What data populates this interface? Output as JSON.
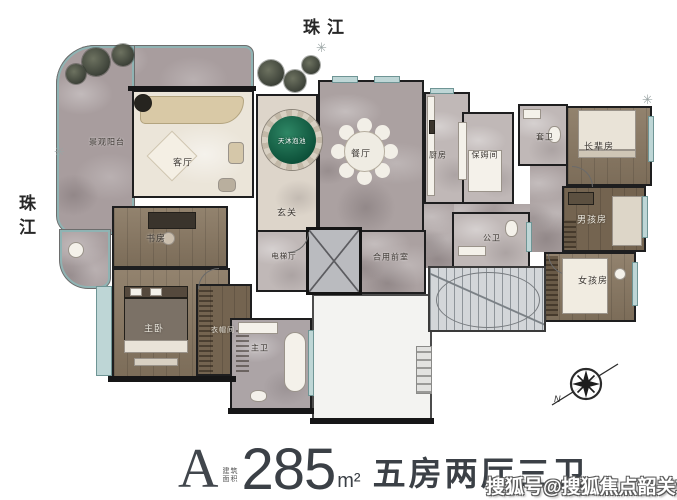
{
  "river_labels": {
    "top": "珠江",
    "left": "珠江"
  },
  "plan": {
    "rooms": {
      "balcony": "景观阳台",
      "living": "客厅",
      "pool": "天沐泡池",
      "foyer": "玄关",
      "dining": "餐厅",
      "kitchen": "厨房",
      "nanny": "保姆间",
      "suite_bath": "套卫",
      "elder": "长辈房",
      "boy": "男孩房",
      "girl": "女孩房",
      "public_bath": "公卫",
      "shared_front": "合用前室",
      "elevator_hall": "电梯厅",
      "study": "书房",
      "master": "主卧",
      "closet": "衣帽间",
      "master_bath": "主卫"
    },
    "compass_north": "N"
  },
  "title": {
    "unit": "A",
    "area_note_line1": "建筑",
    "area_note_line2": "面积",
    "area_value": "285",
    "area_unit": "m²",
    "layout": "五房两厅三卫"
  },
  "watermark": "搜狐号@搜狐焦点韶关站",
  "colors": {
    "pool_green": "#0c4f38",
    "wood": "#8a7963",
    "marble": "#aba1a1",
    "wall": "#1e1e1f",
    "window_glass": "#bed6d6",
    "title_text": "#3b4046"
  }
}
